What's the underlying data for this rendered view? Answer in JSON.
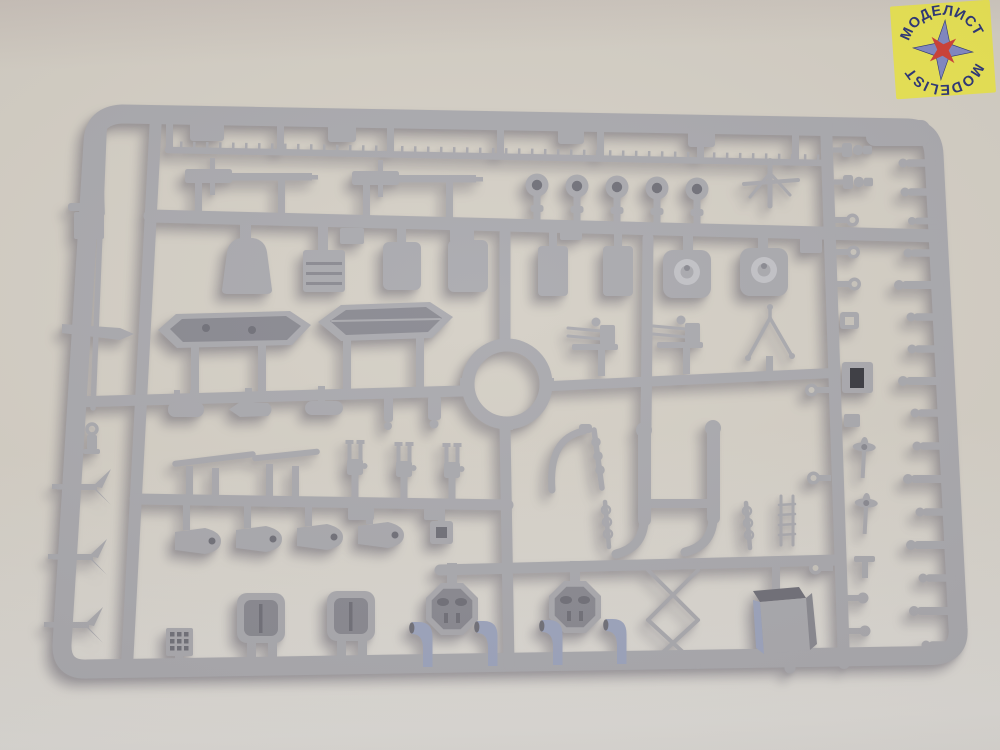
{
  "photo": {
    "subject": "Light-grey injection-molded polystyrene sprue (model kit parts frame) with ship fittings, photographed on a beige tabletop",
    "brand_sticker_position": "top-right corner"
  },
  "logo": {
    "top_text": "МОДЕЛИСТ",
    "bottom_text": "MODELIST"
  },
  "colors": {
    "background-top": "#c8c0b9",
    "background-mid": "#d3cec4",
    "background-bottom": "#dcdad6",
    "plastic": "#a7a7ac",
    "plastic-light": "#c0c0c5",
    "plastic-dark": "#86868e",
    "plastic-deep": "#6c6c75",
    "plastic-blue": "#9aa2bc",
    "hole": "#34343b",
    "sticker": "#e8e34e",
    "logo-text": "#242e73",
    "star-blue": "#7d85c3",
    "star-red": "#cc3a31"
  },
  "parts_inventory": [
    {
      "name": "ship-mast-rod",
      "count": 1
    },
    {
      "name": "railing-strip",
      "count": 1
    },
    {
      "name": "naval-gun-barrel",
      "count": 2
    },
    {
      "name": "searchlight",
      "count": 5
    },
    {
      "name": "gun-pedestal-mount",
      "count": 4
    },
    {
      "name": "ammunition-box",
      "count": 1
    },
    {
      "name": "turret-base-with-cap",
      "count": 2
    },
    {
      "name": "open-ships-boat",
      "count": 1
    },
    {
      "name": "whaleboat",
      "count": 1
    },
    {
      "name": "ring-platform",
      "count": 1
    },
    {
      "name": "anchor",
      "count": 3
    },
    {
      "name": "anchor-swivel",
      "count": 1
    },
    {
      "name": "torpedo-shaped-fitting",
      "count": 4
    },
    {
      "name": "yardarm",
      "count": 2
    },
    {
      "name": "twin-aa-gun-mount",
      "count": 3
    },
    {
      "name": "aa-gun-carriage",
      "count": 2
    },
    {
      "name": "tripod-antenna",
      "count": 1
    },
    {
      "name": "paravane",
      "count": 4
    },
    {
      "name": "deck-hatch",
      "count": 2
    },
    {
      "name": "grating",
      "count": 1
    },
    {
      "name": "octagonal-gun-platform",
      "count": 2
    },
    {
      "name": "cowl-ventilator",
      "count": 4
    },
    {
      "name": "davit-pair-frame",
      "count": 1
    },
    {
      "name": "davit",
      "count": 1
    },
    {
      "name": "ringed-signal-pole",
      "count": 2
    },
    {
      "name": "accommodation-ladder-frame",
      "count": 1
    },
    {
      "name": "deck-box",
      "count": 1
    },
    {
      "name": "ladder",
      "count": 1
    },
    {
      "name": "propeller-on-shaft",
      "count": 2
    },
    {
      "name": "eyelet-ring",
      "count": 6
    },
    {
      "name": "stepped-bollard",
      "count": 2
    },
    {
      "name": "square-eyelet",
      "count": 1
    },
    {
      "name": "dark-hole-fitting",
      "count": 1
    },
    {
      "name": "ball-capstan-pin",
      "count": 16
    },
    {
      "name": "mooring-block",
      "count": 2
    }
  ]
}
